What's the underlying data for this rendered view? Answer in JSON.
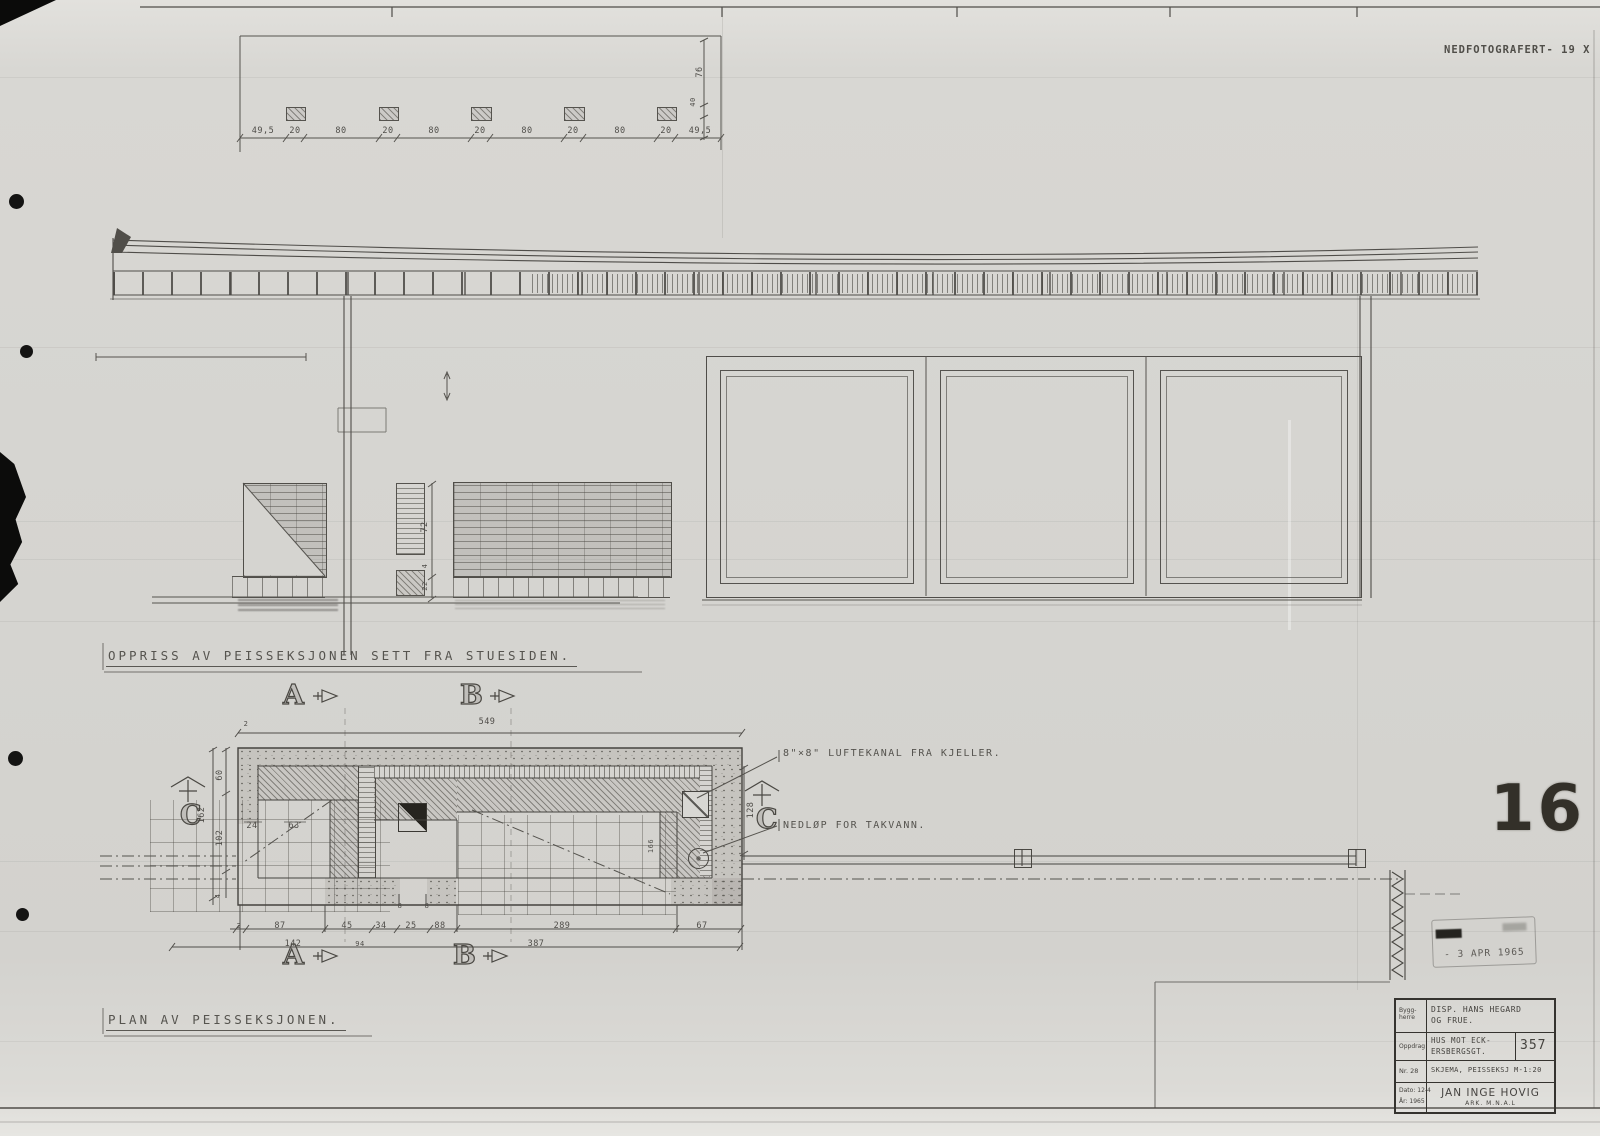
{
  "meta": {
    "photo_note": "NEDFOTOGRAFERT- 19 X",
    "page_number": "16",
    "stamp_date": "- 3 APR 1965"
  },
  "top_detail": {
    "dims": [
      "49,5",
      "20",
      "80",
      "20",
      "80",
      "20",
      "80",
      "20",
      "80",
      "20",
      "49,5"
    ],
    "dim_right_large": "76",
    "dim_right_small": "40"
  },
  "elevation": {
    "title": "OPPRISS AV PEISSEKSJONEN SETT FRA STUESIDEN.",
    "dims": [
      "72",
      "4",
      "22"
    ]
  },
  "plan": {
    "title": "PLAN AV PEISSEKSJONEN.",
    "dim_top": "549",
    "dim_top_small": "2",
    "left_dims": [
      "60",
      "102",
      "162",
      "4"
    ],
    "right_dims": [
      "128",
      "166"
    ],
    "inner_dims": [
      "24",
      "63"
    ],
    "small_dims": [
      "8",
      "8"
    ],
    "bottom_dims_row1": [
      "2",
      "87",
      "45",
      "34",
      "25",
      "88",
      "289",
      "67"
    ],
    "bottom_dims_row2": [
      "142",
      "94",
      "387"
    ]
  },
  "annotations": {
    "duct": "8\"×8\" LUFTEKANAL FRA KJELLER.",
    "drain": "NEDLØP FOR TAKVANN."
  },
  "sections": {
    "a": "A",
    "b": "B",
    "c": "C"
  },
  "title_block": {
    "byggherre_label": "Bygg-\nherre",
    "byggherre": "DISP. HANS HEGARD\nOG FRUE.",
    "oppdrag_label": "Oppdrag",
    "oppdrag": "HUS MOT ECK-\nERSBERGSGT.",
    "oppdrag_nr": "357",
    "nr_label": "Nr. 28",
    "skjema": "SKJEMA, PEISSEKSJ M-1:20",
    "dato": "Dato: 12-4",
    "ar": "År: 1965",
    "architect": "JAN INGE HOVIG",
    "architect_title": "ARK. M.N.A.L"
  },
  "colors": {
    "paper": "#d6d5d1",
    "ink": "#4a4843",
    "stamp_dark": "#333029"
  }
}
